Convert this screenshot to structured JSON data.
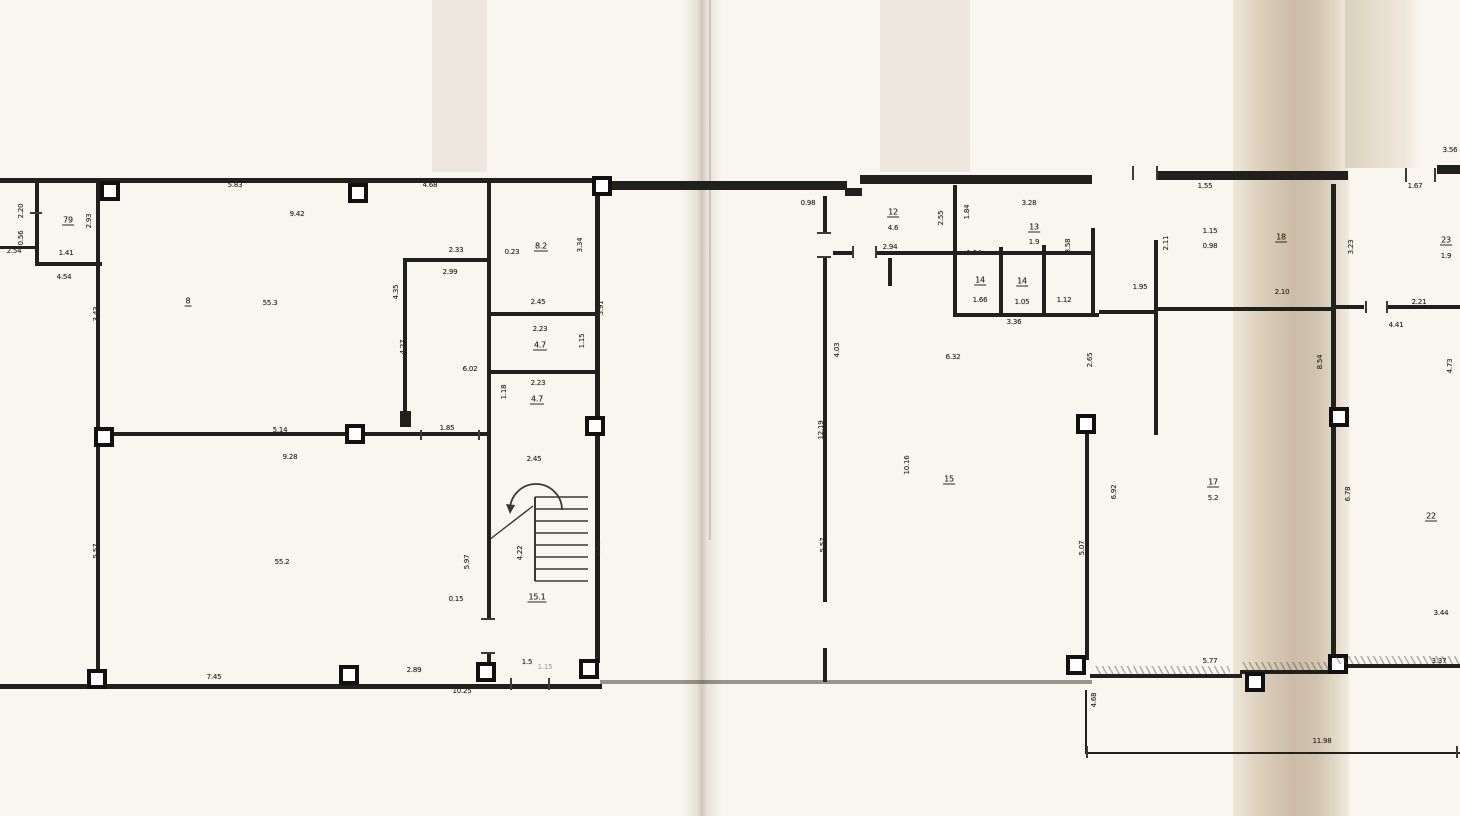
{
  "document": {
    "kind": "scanned-floor-plan",
    "paper_color": "#f8f6ef",
    "ink_color": "#20201d",
    "fold_shadow_color": "#c9b9a1",
    "crease_color": "#b9b2a2"
  },
  "labels": [
    {
      "t": "2.20",
      "x": 21,
      "y": 211,
      "r": 1
    },
    {
      "t": "0.56",
      "x": 21,
      "y": 238,
      "r": 1
    },
    {
      "t": "2.54",
      "x": 14,
      "y": 251
    },
    {
      "t": "79",
      "x": 68,
      "y": 221,
      "u": 1
    },
    {
      "t": "1.41",
      "x": 66,
      "y": 253
    },
    {
      "t": "4.54",
      "x": 64,
      "y": 277
    },
    {
      "t": "2.93",
      "x": 89,
      "y": 221,
      "r": 1
    },
    {
      "t": "5.83",
      "x": 235,
      "y": 185
    },
    {
      "t": "9.42",
      "x": 297,
      "y": 214
    },
    {
      "t": "8",
      "x": 188,
      "y": 302,
      "u": 1
    },
    {
      "t": "55.3",
      "x": 270,
      "y": 303
    },
    {
      "t": "3.43",
      "x": 96,
      "y": 314,
      "r": 1
    },
    {
      "t": "4.68",
      "x": 430,
      "y": 185
    },
    {
      "t": "2.33",
      "x": 456,
      "y": 250
    },
    {
      "t": "2.99",
      "x": 450,
      "y": 272
    },
    {
      "t": "4.35",
      "x": 396,
      "y": 292,
      "r": 1
    },
    {
      "t": "4.27",
      "x": 403,
      "y": 347,
      "r": 1
    },
    {
      "t": "6.02",
      "x": 470,
      "y": 369
    },
    {
      "t": "0.23",
      "x": 512,
      "y": 252
    },
    {
      "t": "8.2",
      "x": 541,
      "y": 247,
      "u": 1
    },
    {
      "t": "3.34",
      "x": 580,
      "y": 245,
      "r": 1
    },
    {
      "t": "5.91",
      "x": 601,
      "y": 308,
      "r": 1
    },
    {
      "t": "2.45",
      "x": 538,
      "y": 302
    },
    {
      "t": "2.23",
      "x": 540,
      "y": 329
    },
    {
      "t": "4.7",
      "x": 540,
      "y": 346,
      "u": 1
    },
    {
      "t": "1.15",
      "x": 582,
      "y": 341,
      "r": 1
    },
    {
      "t": "2.23",
      "x": 538,
      "y": 383
    },
    {
      "t": "4.7",
      "x": 537,
      "y": 400,
      "u": 1
    },
    {
      "t": "1.18",
      "x": 504,
      "y": 392,
      "r": 1
    },
    {
      "t": "1.85",
      "x": 447,
      "y": 428
    },
    {
      "t": "2.45",
      "x": 534,
      "y": 459
    },
    {
      "t": "5.97",
      "x": 467,
      "y": 562,
      "r": 1
    },
    {
      "t": "4.22",
      "x": 520,
      "y": 553,
      "r": 1
    },
    {
      "t": "3.62",
      "x": 598,
      "y": 549,
      "r": 1
    },
    {
      "t": "0.15",
      "x": 456,
      "y": 599
    },
    {
      "t": "15.1",
      "x": 537,
      "y": 598,
      "u": 1
    },
    {
      "t": "1.5",
      "x": 527,
      "y": 662
    },
    {
      "t": "5.14",
      "x": 280,
      "y": 430
    },
    {
      "t": "9.28",
      "x": 290,
      "y": 457
    },
    {
      "t": "55.2",
      "x": 282,
      "y": 562
    },
    {
      "t": "5.57",
      "x": 96,
      "y": 551,
      "r": 1
    },
    {
      "t": "7.45",
      "x": 214,
      "y": 677
    },
    {
      "t": "2.89",
      "x": 414,
      "y": 670
    },
    {
      "t": "10.25",
      "x": 462,
      "y": 691
    },
    {
      "t": "1.15",
      "x": 545,
      "y": 667,
      "f": 1
    },
    {
      "t": "0.98",
      "x": 808,
      "y": 203
    },
    {
      "t": "12",
      "x": 893,
      "y": 213,
      "u": 1
    },
    {
      "t": "4.6",
      "x": 893,
      "y": 228
    },
    {
      "t": "2.94",
      "x": 890,
      "y": 247
    },
    {
      "t": "2.55",
      "x": 941,
      "y": 218,
      "r": 1
    },
    {
      "t": "1.84",
      "x": 967,
      "y": 212,
      "r": 1
    },
    {
      "t": "3.28",
      "x": 1029,
      "y": 203
    },
    {
      "t": "13",
      "x": 1034,
      "y": 228,
      "u": 1
    },
    {
      "t": "1.9",
      "x": 1034,
      "y": 242
    },
    {
      "t": "3.58",
      "x": 1068,
      "y": 246,
      "r": 1
    },
    {
      "t": "1.54",
      "x": 974,
      "y": 253
    },
    {
      "t": "14",
      "x": 980,
      "y": 281,
      "u": 1
    },
    {
      "t": "1.66",
      "x": 980,
      "y": 300
    },
    {
      "t": "14",
      "x": 1022,
      "y": 282,
      "u": 1
    },
    {
      "t": "1.05",
      "x": 1022,
      "y": 302
    },
    {
      "t": "3.36",
      "x": 1014,
      "y": 322
    },
    {
      "t": "1.12",
      "x": 1064,
      "y": 300
    },
    {
      "t": "1.95",
      "x": 1140,
      "y": 287
    },
    {
      "t": "4.03",
      "x": 837,
      "y": 350,
      "r": 1
    },
    {
      "t": "12.19",
      "x": 821,
      "y": 430,
      "r": 1
    },
    {
      "t": "5.57",
      "x": 823,
      "y": 545,
      "r": 1
    },
    {
      "t": "6.32",
      "x": 953,
      "y": 357
    },
    {
      "t": "10.16",
      "x": 907,
      "y": 465,
      "r": 1
    },
    {
      "t": "15",
      "x": 949,
      "y": 480,
      "u": 1
    },
    {
      "t": "2.65",
      "x": 1090,
      "y": 360,
      "r": 1
    },
    {
      "t": "5.07",
      "x": 1082,
      "y": 548,
      "r": 1
    },
    {
      "t": "6.92",
      "x": 1114,
      "y": 492,
      "r": 1
    },
    {
      "t": "1.55",
      "x": 1205,
      "y": 186
    },
    {
      "t": "3.56",
      "x": 1450,
      "y": 150
    },
    {
      "t": "1.67",
      "x": 1415,
      "y": 186
    },
    {
      "t": "2.11",
      "x": 1166,
      "y": 243,
      "r": 1
    },
    {
      "t": "1.15",
      "x": 1210,
      "y": 231
    },
    {
      "t": "0.98",
      "x": 1210,
      "y": 246
    },
    {
      "t": "18",
      "x": 1281,
      "y": 238,
      "u": 1
    },
    {
      "t": "2.10",
      "x": 1282,
      "y": 292
    },
    {
      "t": "3.23",
      "x": 1351,
      "y": 247,
      "r": 1
    },
    {
      "t": "23",
      "x": 1446,
      "y": 241,
      "u": 1
    },
    {
      "t": "1.9",
      "x": 1446,
      "y": 256
    },
    {
      "t": "2.21",
      "x": 1419,
      "y": 302
    },
    {
      "t": "4.41",
      "x": 1396,
      "y": 325
    },
    {
      "t": "8.54",
      "x": 1320,
      "y": 362,
      "r": 1
    },
    {
      "t": "4.73",
      "x": 1450,
      "y": 366,
      "r": 1
    },
    {
      "t": "17",
      "x": 1213,
      "y": 483,
      "u": 1
    },
    {
      "t": "5.2",
      "x": 1213,
      "y": 498
    },
    {
      "t": "6.78",
      "x": 1348,
      "y": 494,
      "r": 1
    },
    {
      "t": "22",
      "x": 1431,
      "y": 517,
      "u": 1
    },
    {
      "t": "3.44",
      "x": 1441,
      "y": 613
    },
    {
      "t": "3.37",
      "x": 1439,
      "y": 661
    },
    {
      "t": "5.77",
      "x": 1210,
      "y": 661
    },
    {
      "t": "11.98",
      "x": 1322,
      "y": 741
    },
    {
      "t": "4.68",
      "x": 1094,
      "y": 700,
      "r": 1
    }
  ],
  "walls": [
    [
      0,
      178,
      600,
      5
    ],
    [
      597,
      181,
      250,
      9
    ],
    [
      845,
      188,
      17,
      8
    ],
    [
      860,
      175,
      232,
      9
    ],
    [
      1158,
      171,
      190,
      9
    ],
    [
      1437,
      165,
      23,
      9
    ],
    [
      96,
      181,
      4,
      507
    ],
    [
      0,
      684,
      602,
      5
    ],
    [
      600,
      680,
      492,
      4,
      0.45
    ],
    [
      1090,
      674,
      152,
      4
    ],
    [
      1240,
      670,
      95,
      4
    ],
    [
      1333,
      664,
      127,
      4
    ],
    [
      35,
      180,
      4,
      86
    ],
    [
      35,
      262,
      67,
      4
    ],
    [
      0,
      246,
      37,
      3
    ],
    [
      403,
      258,
      4,
      160
    ],
    [
      403,
      258,
      88,
      4
    ],
    [
      487,
      182,
      4,
      436
    ],
    [
      487,
      654,
      4,
      22
    ],
    [
      595,
      195,
      5,
      468
    ],
    [
      487,
      312,
      113,
      4
    ],
    [
      487,
      370,
      113,
      4
    ],
    [
      96,
      432,
      393,
      4
    ],
    [
      823,
      196,
      4,
      36
    ],
    [
      823,
      258,
      4,
      344
    ],
    [
      823,
      648,
      4,
      34
    ],
    [
      833,
      251,
      19,
      4
    ],
    [
      877,
      251,
      218,
      4
    ],
    [
      953,
      185,
      4,
      130
    ],
    [
      888,
      258,
      4,
      28
    ],
    [
      999,
      247,
      4,
      68
    ],
    [
      1042,
      245,
      4,
      70
    ],
    [
      1091,
      228,
      4,
      87
    ],
    [
      953,
      313,
      146,
      4
    ],
    [
      1099,
      310,
      57,
      4
    ],
    [
      1154,
      240,
      4,
      195
    ],
    [
      1331,
      184,
      5,
      226
    ],
    [
      1331,
      427,
      5,
      230
    ],
    [
      1154,
      307,
      182,
      4
    ],
    [
      1336,
      305,
      28,
      4
    ],
    [
      1388,
      305,
      74,
      4
    ],
    [
      1085,
      432,
      4,
      228
    ],
    [
      1085,
      690,
      2,
      64
    ],
    [
      1085,
      752,
      375,
      2
    ]
  ],
  "columns": [
    [
      100,
      181
    ],
    [
      348,
      183
    ],
    [
      592,
      176
    ],
    [
      94,
      427
    ],
    [
      345,
      424
    ],
    [
      585,
      416
    ],
    [
      1076,
      414
    ],
    [
      1329,
      407
    ],
    [
      87,
      669
    ],
    [
      339,
      665
    ],
    [
      476,
      662
    ],
    [
      579,
      659
    ],
    [
      1066,
      655
    ],
    [
      1328,
      654
    ],
    [
      1245,
      672
    ]
  ],
  "filled_blocks": [
    [
      400,
      411,
      11,
      16
    ]
  ],
  "ticks": [
    [
      852,
      246,
      2,
      12
    ],
    [
      875,
      246,
      2,
      12
    ],
    [
      1365,
      301,
      2,
      12
    ],
    [
      1386,
      301,
      2,
      12
    ],
    [
      1405,
      168,
      2,
      14
    ],
    [
      1434,
      168,
      2,
      14
    ],
    [
      1132,
      166,
      2,
      14
    ],
    [
      1156,
      166,
      2,
      14
    ],
    [
      481,
      618,
      14,
      2
    ],
    [
      481,
      652,
      14,
      2
    ],
    [
      420,
      430,
      2,
      10
    ],
    [
      478,
      430,
      2,
      10
    ],
    [
      817,
      232,
      14,
      2
    ],
    [
      817,
      256,
      14,
      2
    ],
    [
      510,
      678,
      2,
      12
    ],
    [
      548,
      678,
      2,
      12
    ],
    [
      30,
      212,
      12,
      2
    ],
    [
      1086,
      746,
      2,
      12
    ],
    [
      1456,
      746,
      2,
      12
    ]
  ],
  "hatches": [
    [
      1095,
      666,
      135,
      8
    ],
    [
      1242,
      662,
      90,
      8
    ],
    [
      1335,
      656,
      125,
      8
    ]
  ],
  "stairs": {
    "origin": [
      480,
      440
    ],
    "treads_x": [
      55,
      108
    ],
    "treads_y_start": 57,
    "treads_step": 12,
    "treads_count": 8,
    "arc": "M 30 70 A 26 26 0 0 1 82 70",
    "flight_divider": [
      55,
      57,
      55,
      141
    ],
    "diagonal": [
      9,
      100,
      53,
      66
    ]
  }
}
